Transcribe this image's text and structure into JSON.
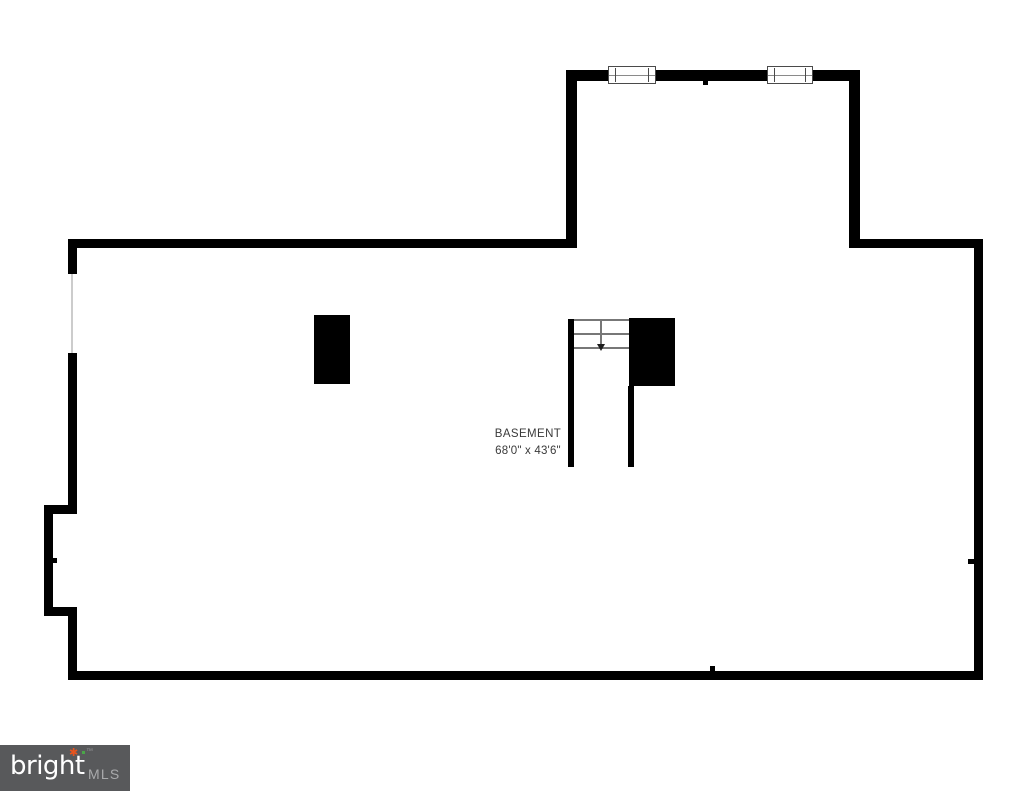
{
  "plan": {
    "room": {
      "name": "BASEMENT",
      "dimensions": "68'0\" x 43'6\""
    },
    "features": {
      "stairs_direction": "down",
      "windows_count": 2,
      "pillars_count": 2
    }
  },
  "watermark": {
    "brand": "bright",
    "suffix": "MLS",
    "trademark": "™",
    "spark_glyph": "✱"
  },
  "colors": {
    "page_bg": "#ffffff",
    "wall": "#000000",
    "label_text": "#3a3a3a",
    "stair_line": "#777777",
    "faint_opening": "#cccccc",
    "logo_bg": "#58595b",
    "logo_brand": "#ffffff",
    "logo_suffix": "#a9aaac",
    "logo_spark_orange": "#e8541d",
    "logo_spark_green": "#4aa648"
  }
}
